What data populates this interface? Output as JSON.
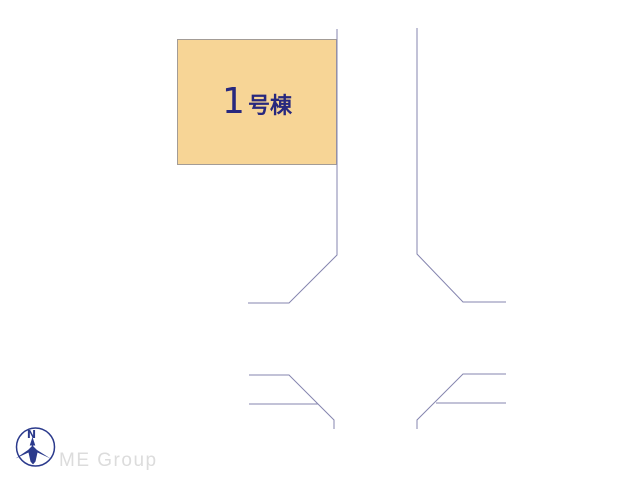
{
  "canvas": {
    "width": 640,
    "height": 480,
    "background": "#FFFFFF"
  },
  "building": {
    "number": "1",
    "suffix": "号棟",
    "fill": "#F7D596",
    "border_color": "#A39C96",
    "text_color": "#28287E"
  },
  "site_plan": {
    "line_color": "#8585AF",
    "lines": [
      {
        "name": "road-edge-left-upper",
        "points": "337,29 337,255 289,303 248,303"
      },
      {
        "name": "road-edge-right-upper",
        "points": "417,28 417,254 463,302 506,302"
      },
      {
        "name": "road-edge-left-lower",
        "points": "249,375 289,375 334,420 334,429"
      },
      {
        "name": "road-line-left-lower-inner",
        "points": "249,404 318,404"
      },
      {
        "name": "road-edge-right-lower",
        "points": "506,374 463,374 417,420 417,429"
      },
      {
        "name": "road-line-right-lower-inner",
        "points": "436,403 506,403"
      }
    ]
  },
  "compass": {
    "label": "N",
    "color": "#2B3A8C"
  },
  "footer": {
    "brand": "ME Group",
    "color": "#DCDCDC"
  }
}
